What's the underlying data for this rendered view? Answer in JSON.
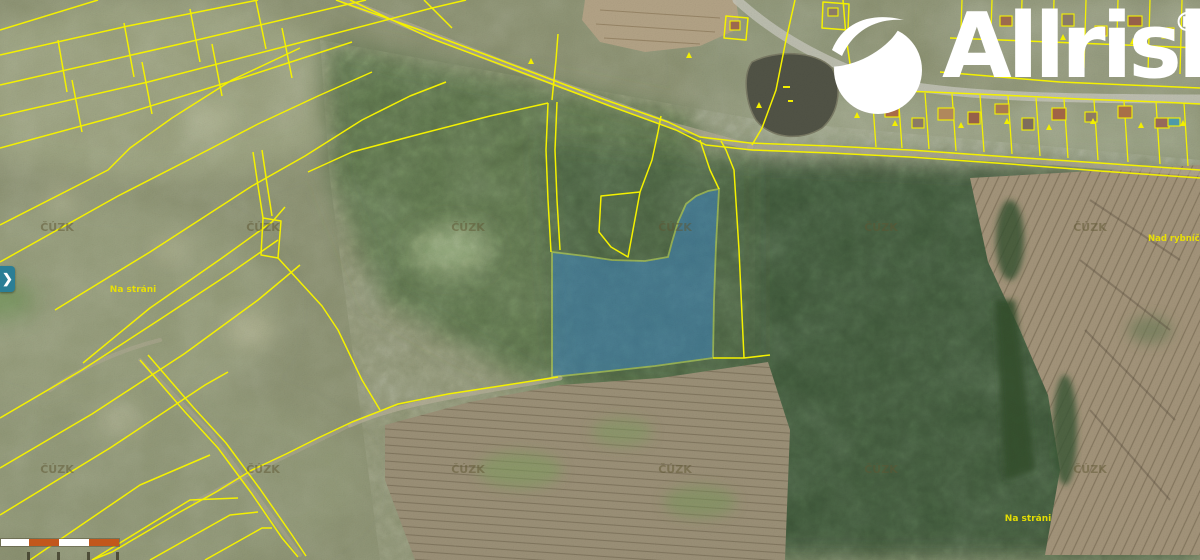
{
  "brand": {
    "wordmark": "Allrisk",
    "registered_mark": "®"
  },
  "map": {
    "provider_watermark": "ČÚZK",
    "place_labels": [
      {
        "text": "Na stráni"
      },
      {
        "text": "Nad rybníčkem"
      },
      {
        "text": "Na stráni"
      }
    ],
    "colors": {
      "parcel_line": "#f4f100",
      "label_text": "#ece400",
      "watermark_text": "#5f5733",
      "highlight_fill": "#3d85c4",
      "highlight_outline": "#cde95e",
      "road_gray": "#bdb6a0",
      "pond_water": "#515346"
    },
    "highlighted_parcel": {
      "present": "true"
    }
  },
  "controls": {
    "expand_chevron": "❯"
  },
  "scalebar": {
    "segments": [
      {
        "color": "#ffffff"
      },
      {
        "color": "#c2571c"
      },
      {
        "color": "#ffffff"
      },
      {
        "color": "#c2571c"
      }
    ]
  }
}
